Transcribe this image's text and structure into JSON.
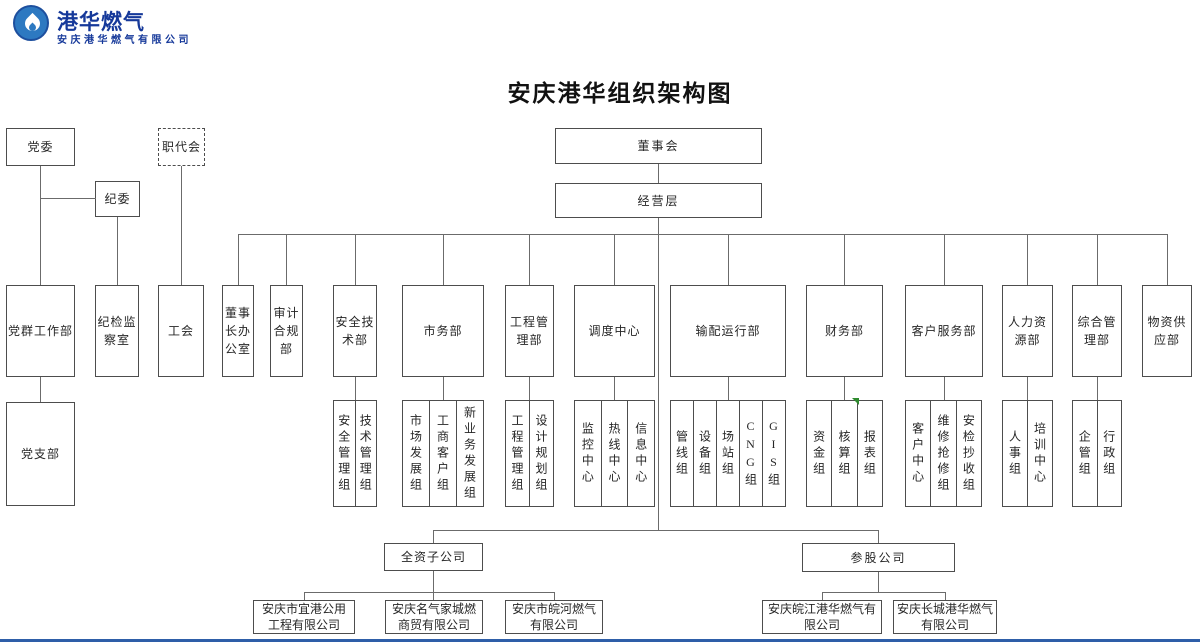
{
  "logo": {
    "brand": "港华燃气",
    "company": "安庆港华燃气有限公司",
    "icon": "flame-in-circle"
  },
  "title": "安庆港华组织架构图",
  "top": {
    "party_committee": "党委",
    "discipline_committee": "纪委",
    "staff_congress": "职代会",
    "board_of_directors": "董事会",
    "management_level": "经营层"
  },
  "departments": [
    {
      "label": "党群工作部"
    },
    {
      "label": "纪检监察室"
    },
    {
      "label": "工会"
    },
    {
      "label": "董事长办公室"
    },
    {
      "label": "审计合规部"
    },
    {
      "label": "安全技术部"
    },
    {
      "label": "市务部"
    },
    {
      "label": "工程管理部"
    },
    {
      "label": "调度中心"
    },
    {
      "label": "输配运行部"
    },
    {
      "label": "财务部"
    },
    {
      "label": "客户服务部"
    },
    {
      "label": "人力资源部"
    },
    {
      "label": "综合管理部"
    },
    {
      "label": "物资供应部"
    }
  ],
  "teams": {
    "party": "党支部",
    "safety": [
      "安全管理组",
      "技术管理组"
    ],
    "market": [
      "市场发展组",
      "工商客户组",
      "新业务发展组"
    ],
    "engineering": [
      "工程管理组",
      "设计规划组"
    ],
    "dispatch": [
      "监控中心",
      "热线中心",
      "信息中心"
    ],
    "distribution": [
      "管线组",
      "设备组",
      "场站组",
      "CNG组",
      "GIS组"
    ],
    "finance": [
      "资金组",
      "核算组",
      "报表组"
    ],
    "customer": [
      "客户中心",
      "维修抢修组",
      "安检抄收组"
    ],
    "hr": [
      "人事组",
      "培训中心"
    ],
    "admin": [
      "企管组",
      "行政组"
    ]
  },
  "subsidiaries": {
    "wholly_owned": {
      "label": "全资子公司",
      "companies": [
        "安庆市宜港公用\n工程有限公司",
        "安庆名气家城燃\n商贸有限公司",
        "安庆市皖河燃气\n有限公司"
      ]
    },
    "invested": {
      "label": "参股公司",
      "companies": [
        "安庆皖江港华燃气有\n限公司",
        "安庆长城港华燃气\n有限公司"
      ]
    }
  },
  "colors": {
    "brand_blue": "#16399a",
    "circle_blue": "#2d79c1",
    "line_gray": "#6b6b6b",
    "marker_green": "#2e8b2e",
    "footer_blue": "#2e5ea8"
  }
}
